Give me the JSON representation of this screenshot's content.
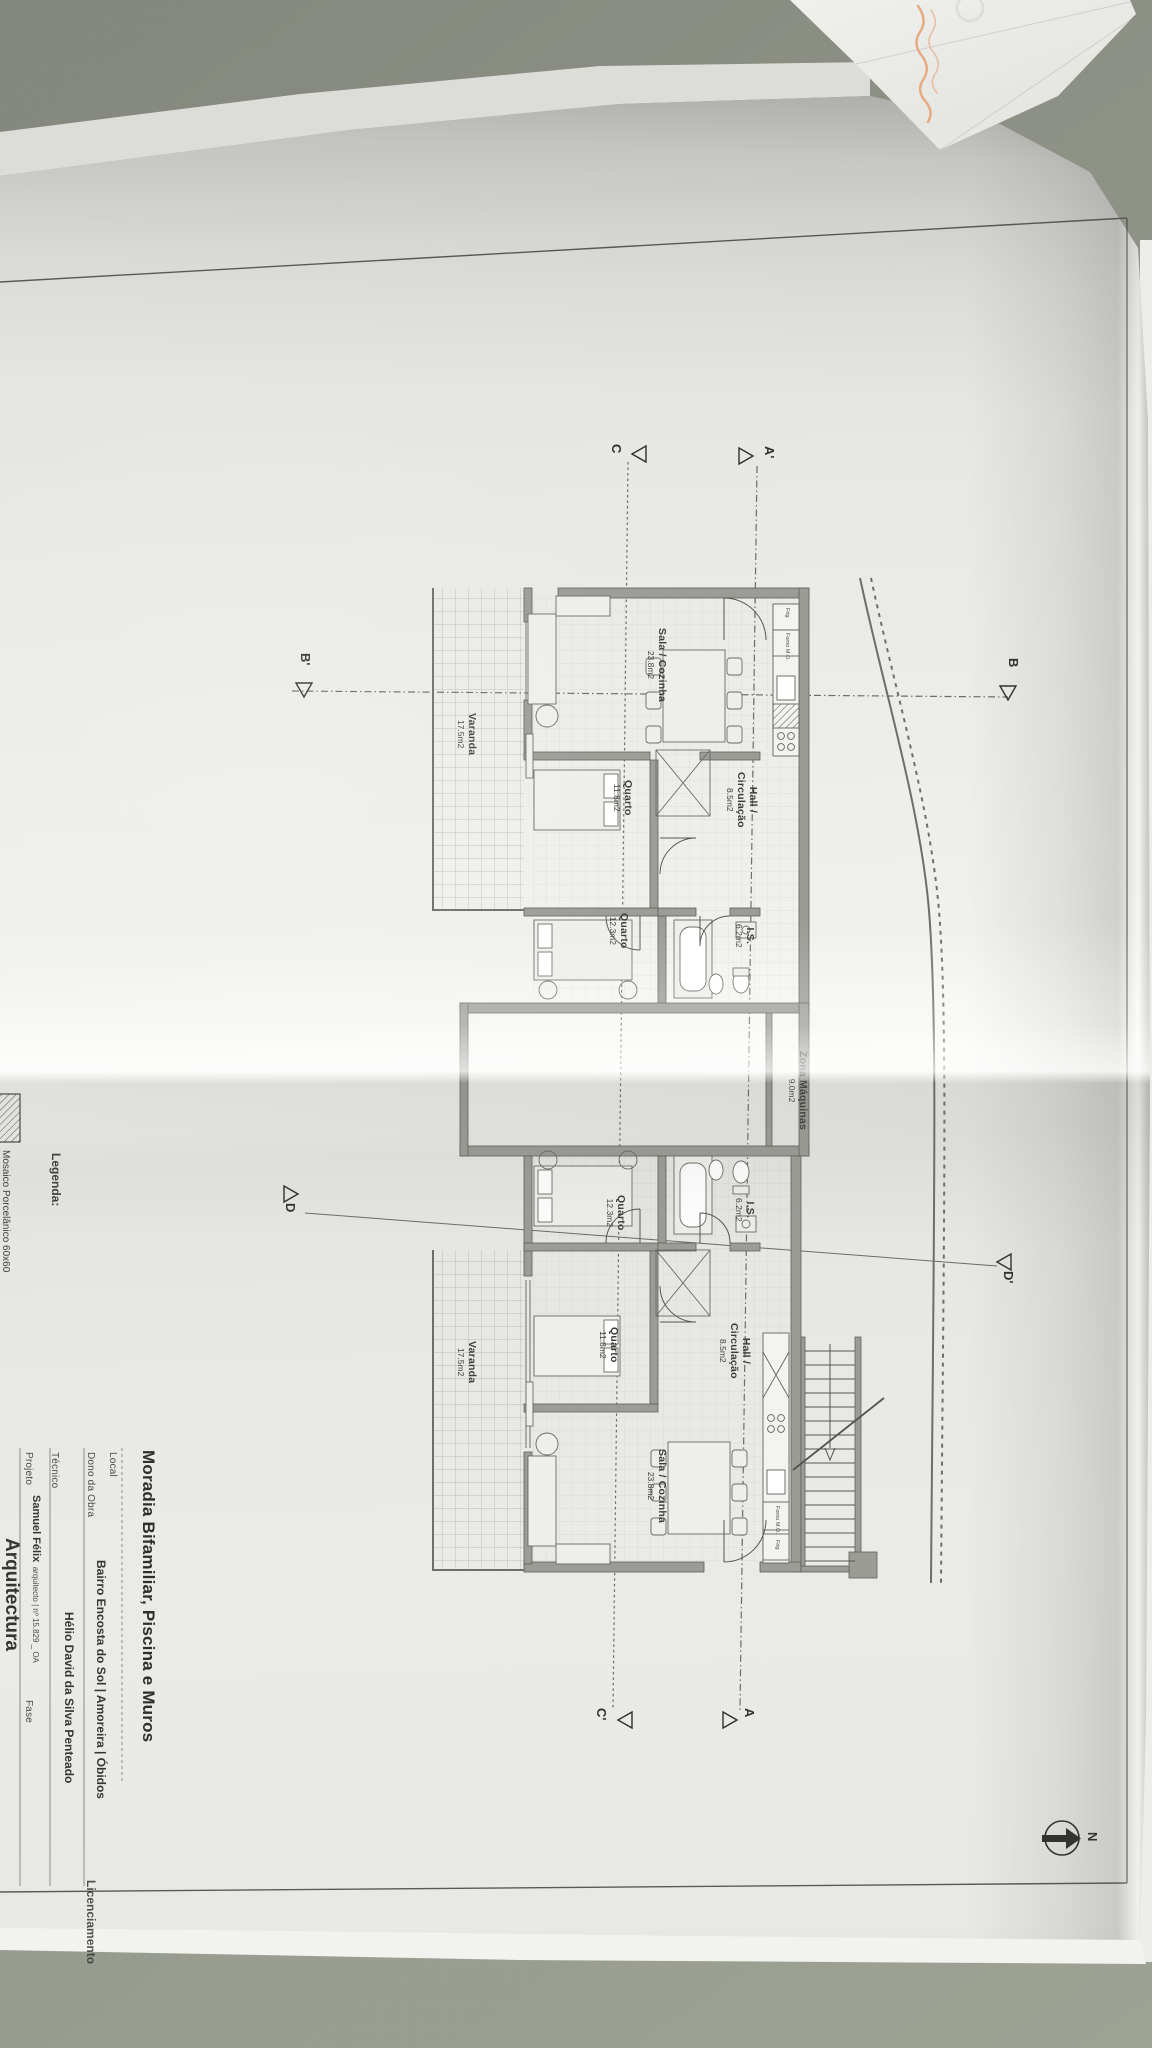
{
  "sheet": {
    "north_label": "N",
    "legend": {
      "heading": "Legenda:",
      "item_label": "Mosaico Porcelânico 60x60"
    },
    "rooms": {
      "sala": {
        "name": "Sala / Cozinha",
        "area": "23.8m2"
      },
      "quarto_1": {
        "name": "Quarto",
        "area": "11.8m2"
      },
      "quarto_2": {
        "name": "Quarto",
        "area": "12.3m2"
      },
      "hall": {
        "name_line1": "Hall /",
        "name_line2": "Circulação",
        "area": "8.5m2"
      },
      "is": {
        "name": "I.S.",
        "area": "6.2m2"
      },
      "varanda": {
        "name": "Varanda",
        "area": "17.5m2"
      },
      "zona_maquinas": {
        "name": "Zona Máquinas",
        "area": "9.0m2"
      }
    },
    "kitchen": {
      "oven": "Forno M.O.",
      "fridge": "Frig"
    },
    "section_markers": {
      "a": "A",
      "a_prime": "A'",
      "b": "B",
      "b_prime": "B'",
      "c": "C",
      "c_prime": "C'",
      "d": "D",
      "d_prime": "D'"
    },
    "title_block": {
      "title": "Moradia Bifamiliar, Piscina e Muros",
      "local_label": "Local",
      "local_value": "Bairro Encosta do Sol | Amoreira | Óbidos",
      "owner_label": "Dono da Obra",
      "owner_value": "Hélio David da Silva Penteado",
      "technician_label": "Técnico",
      "technician_value": "Samuel Félix",
      "technician_value_suffix": "arquitecto | nº 15.829 _ OA",
      "project_label": "Projeto",
      "project_value": "Arquitectura",
      "phase_label": "Fase",
      "phase_value": "Licenciamento"
    }
  }
}
